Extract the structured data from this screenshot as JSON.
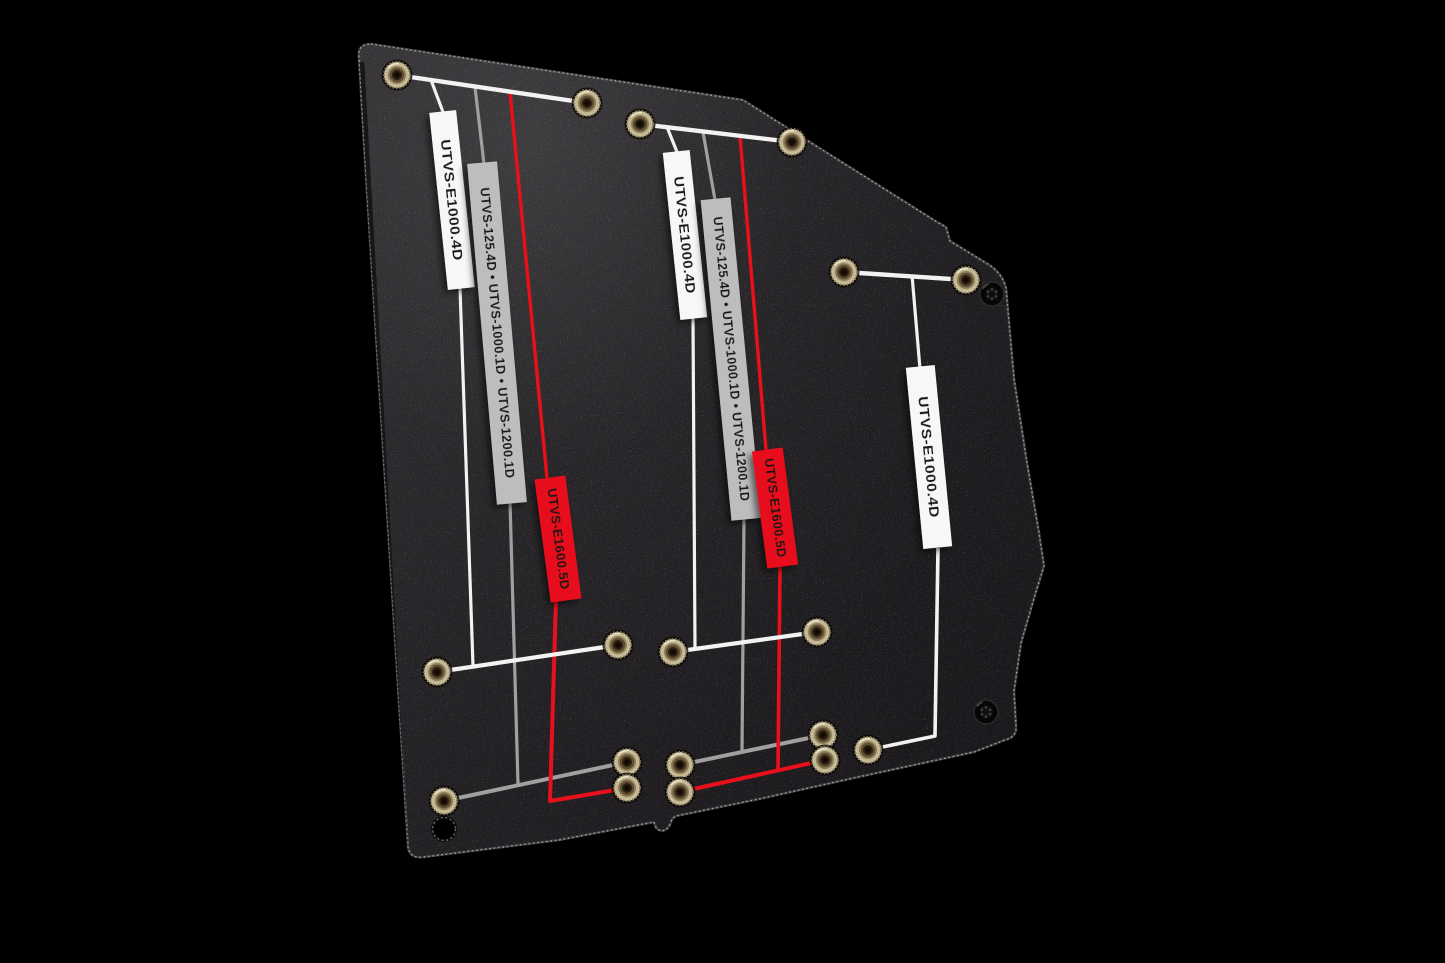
{
  "canvas": {
    "background_color": "#000000"
  },
  "plate": {
    "face_color": "#232124",
    "edge_highlight_color": "#c9c9c9",
    "hardware": {
      "rivet_nut_color": "#cfc4a2",
      "screw_color": "#0b0b0b"
    }
  },
  "colors": {
    "white_label_bg": "#f7f7f7",
    "silver_label_bg": "#bdbdbd",
    "red_label_bg": "#e8101a",
    "white_line": "#f2f2f2",
    "silver_line": "#a0a0a0",
    "red_line": "#e8101a"
  },
  "callout_groups": [
    {
      "id": "left",
      "labels": [
        {
          "style": "white",
          "text": "UTVS-E1000.4D"
        },
        {
          "style": "silver",
          "text": "UTVS-125.4D • UTVS-1000.1D • UTVS-1200.1D"
        },
        {
          "style": "red",
          "text": "UTVS-E1600.5D"
        }
      ]
    },
    {
      "id": "middle",
      "labels": [
        {
          "style": "white",
          "text": "UTVS-E1000.4D"
        },
        {
          "style": "silver",
          "text": "UTVS-125.4D • UTVS-1000.1D • UTVS-1200.1D"
        },
        {
          "style": "red",
          "text": "UTVS-E1600.5D"
        }
      ]
    },
    {
      "id": "right",
      "labels": [
        {
          "style": "white",
          "text": "UTVS-E1000.4D"
        }
      ]
    }
  ]
}
